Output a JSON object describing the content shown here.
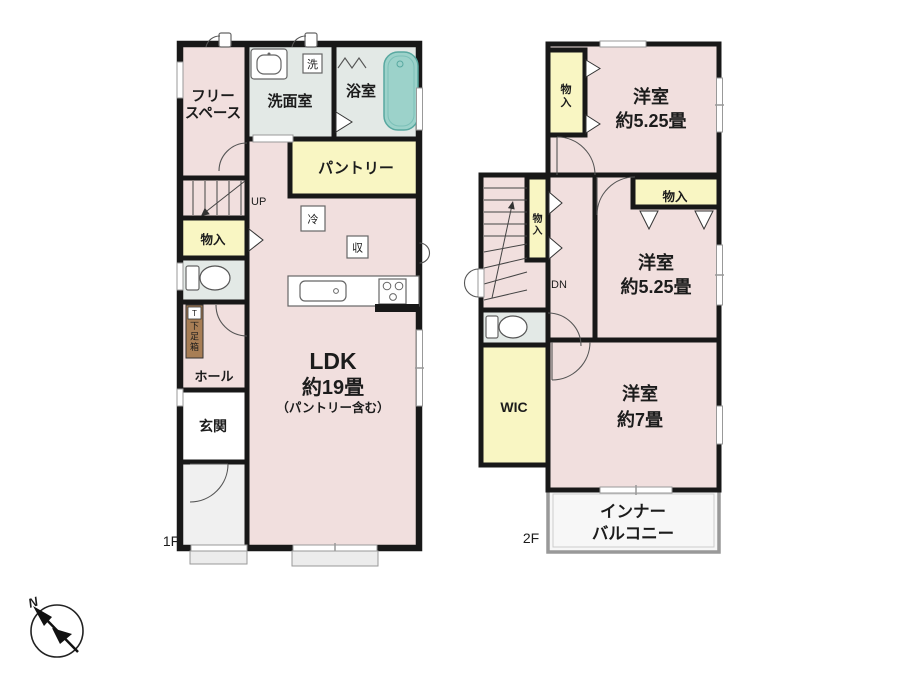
{
  "title": "間取り図",
  "colors": {
    "wall": "#181818",
    "room_pink": "#f1dfde",
    "room_yellow": "#f9f6c3",
    "room_wet_gray": "#e3e9e6",
    "tub_teal": "#9cd2ca",
    "shoe_cabinet_brown": "#a87e55",
    "porch_gray": "#f0f0f0",
    "step_gray": "#ececec"
  },
  "compass": {
    "north_label": "N"
  },
  "floor1": {
    "floor_label": "1F",
    "rooms": {
      "free_space_line1": "フリー",
      "free_space_line2": "スペース",
      "washroom": "洗面室",
      "laundry_mark": "洗",
      "bath": "浴室",
      "pantry": "パントリー",
      "stairs_up": "UP",
      "storage": "物入",
      "shoe_cabinet_mark": "T",
      "shoe_cabinet": "下足箱",
      "hall": "ホール",
      "entrance": "玄関",
      "fridge_mark": "冷",
      "storage_mark": "収",
      "ldk_line1": "LDK",
      "ldk_line2": "約19畳",
      "ldk_line3": "（パントリー含む）"
    }
  },
  "floor2": {
    "floor_label": "2F",
    "rooms": {
      "closet_north": "物入",
      "bedroom1_line1": "洋室",
      "bedroom1_line2": "約5.25畳",
      "closet_mid": "物入",
      "closet_east": "物入",
      "bedroom2_line1": "洋室",
      "bedroom2_line2": "約5.25畳",
      "stairs_down": "DN",
      "wic": "WIC",
      "bedroom3_line1": "洋室",
      "bedroom3_line2": "約7畳",
      "balcony_line1": "インナー",
      "balcony_line2": "バルコニー"
    }
  }
}
